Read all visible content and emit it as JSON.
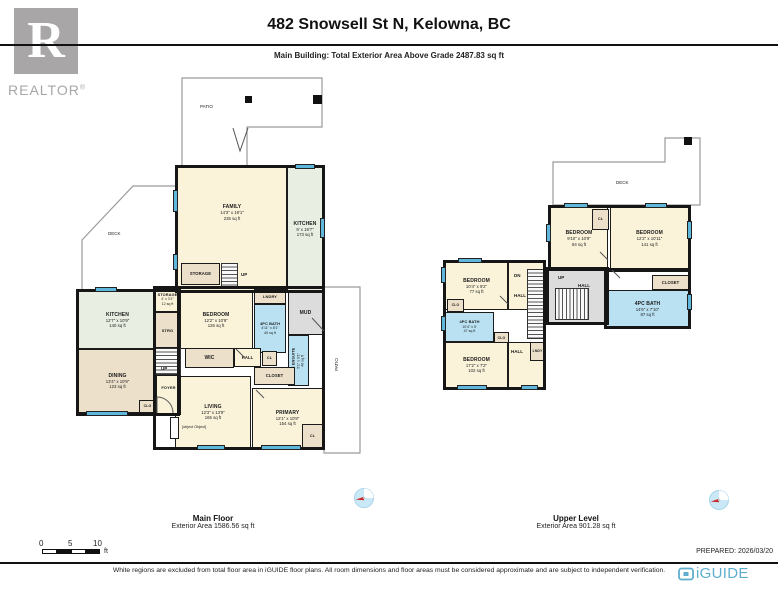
{
  "header": {
    "title": "482 Snowsell St N, Kelowna, BC",
    "subtitle": "Main Building: Total Exterior Area Above Grade 2487.83 sq ft",
    "realtor_r": "R",
    "realtor_text": "REALTOR",
    "realtor_reg": "®"
  },
  "mf": {
    "label": "Main Floor",
    "area_label": "Exterior Area 1586.56 sq ft",
    "patio": "PATIO",
    "patio_side": "PATIO",
    "deck": "DECK",
    "family": {
      "name": "FAMILY",
      "dims": "14'3\" x 19'1\"",
      "area": "235 sq ft"
    },
    "kitchen": {
      "name": "KITCHEN",
      "dims": "9' x 19'7\"",
      "area": "173 sq ft"
    },
    "storage_top": {
      "name": "STORAGE"
    },
    "bedroom": {
      "name": "BEDROOM",
      "dims": "12'2\" x 10'9\"",
      "area": "126 sq ft"
    },
    "lndry": {
      "name": "LNDRY"
    },
    "bath": {
      "name": "4PC BATH",
      "dims": "4'11\" x 8'1\"",
      "area": "40 sq ft"
    },
    "mud": {
      "name": "MUD"
    },
    "ensuite": {
      "name": "3PC ENSUITE",
      "dims": "5'1\" x 9'1\"",
      "area": "46 sq ft"
    },
    "cl": {
      "name": "CL"
    },
    "closet": {
      "name": "CLOSET"
    },
    "wic": {
      "name": "WIC"
    },
    "hall": {
      "name": "HALL"
    },
    "living": {
      "name": "LIVING",
      "dims": "12'3\" x 13'9\"",
      "area": "165 sq ft"
    },
    "primary": {
      "name": "PRIMARY",
      "dims": "12'1\" x 10'8\"",
      "area": "154 sq ft"
    },
    "cl2": {
      "name": "CL"
    },
    "kitchen_left": {
      "name": "KITCHEN",
      "dims": "12'7\" x 10'9\"",
      "area": "140 sq ft"
    },
    "dining": {
      "name": "DINING",
      "dims": "13'4\" x 10'9\"",
      "area": "123 sq ft"
    },
    "storage_small": {
      "name": "STORAGE",
      "dims": "4' x 3'1\"",
      "area": "12 sq ft"
    },
    "strg": {
      "name": "STRG"
    },
    "foyer": {
      "name": "FOYER"
    },
    "clo": {
      "name": "CLO"
    },
    "fp": {
      "name": "F/P"
    },
    "up1": "UP",
    "up2": "UP"
  },
  "ul": {
    "label": "Upper Level",
    "area_label": "Exterior Area 901.28 sq ft",
    "deck": "DECK",
    "bedroom_tl": {
      "name": "BEDROOM",
      "dims": "9'10\" x 10'9\"",
      "area": "84 sq ft"
    },
    "bedroom_tr": {
      "name": "BEDROOM",
      "dims": "12'2\" x 10'11\"",
      "area": "141 sq ft"
    },
    "cl_top": {
      "name": "CL"
    },
    "closet": {
      "name": "CLOSET"
    },
    "bath_right": {
      "name": "4PC BATH",
      "dims": "14'6\" x 7'10\"",
      "area": "87 sq ft"
    },
    "bedroom_ml": {
      "name": "BEDROOM",
      "dims": "10'4\" x 9'2\"",
      "area": "77 sq ft"
    },
    "bath_left": {
      "name": "4PC BATH",
      "dims": "10'4\" x 5'",
      "area": "47 sq ft"
    },
    "bedroom_bl": {
      "name": "BEDROOM",
      "dims": "17'2\" x 7'2\"",
      "area": "102 sq ft"
    },
    "hall_left": "HALL",
    "hall_center": "HALL",
    "hall_bottom": "HALL",
    "lndy": "LNDY",
    "clo1": "CLO",
    "clo2": "CLO",
    "up": "UP",
    "dn": "DN"
  },
  "scale": {
    "t0": "0",
    "t5": "5",
    "t10": "10",
    "unit": "ft"
  },
  "footer": {
    "prepared": "PREPARED: 2026/03/20",
    "disclaimer": "White regions are excluded from total floor area in iGUIDE floor plans. All room dimensions and floor areas must be considered approximate and are subject to independent verification.",
    "brand": "iGUIDE"
  },
  "colors": {
    "room_cream": "#FAF3DA",
    "room_green": "#E8EFE2",
    "room_tan": "#ECE0CA",
    "room_blue": "#B9E1F2",
    "room_gray": "#DCDCDC",
    "window_blue": "#5FB8DC",
    "wall": "#1B1B1B",
    "brand_blue": "#5FAECE",
    "logo_gray": "#A8A6A7",
    "compass_red": "#CC2A2A"
  }
}
